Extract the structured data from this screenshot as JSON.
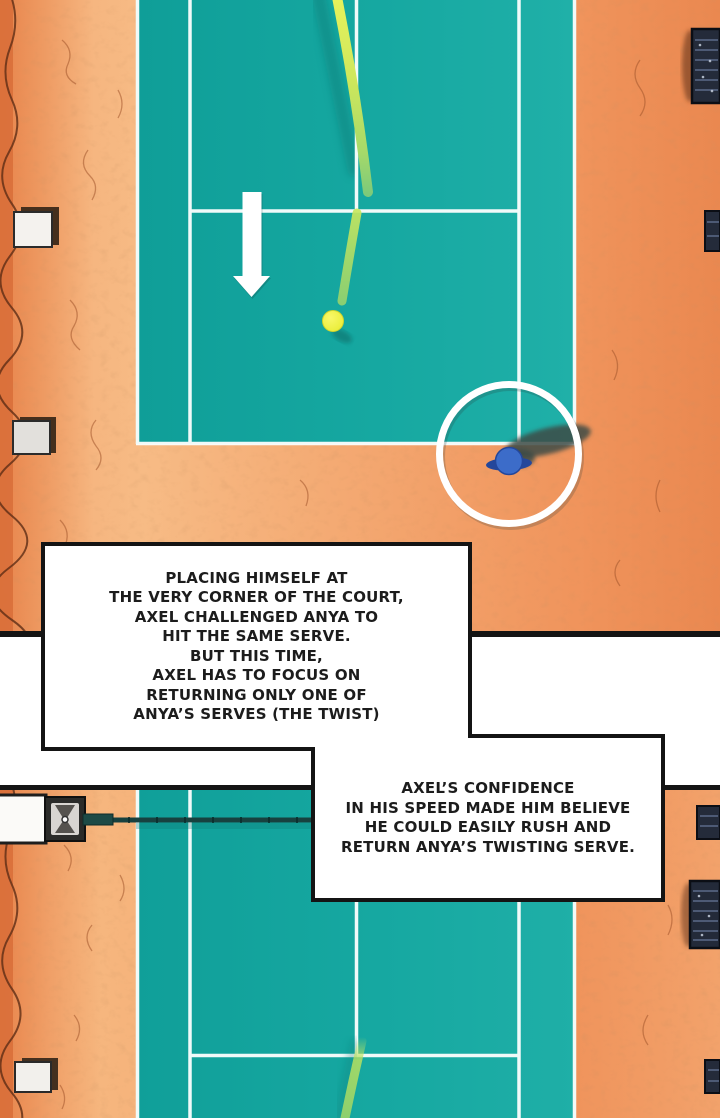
{
  "page": {
    "kind": "webtoon-comic-page",
    "width": 720,
    "height": 1118,
    "background": "#ffffff",
    "panel_count": 2
  },
  "narration": {
    "box1": {
      "text": "PLACING HIMSELF AT\nTHE VERY CORNER OF THE COURT,\nAXEL CHALLENGED ANYA TO\nHIT THE SAME SERVE.\nBUT THIS TIME,\nAXEL HAS TO FOCUS ON\nRETURNING ONLY ONE OF\nANYA’S SERVES (THE TWIST)"
    },
    "box2": {
      "text": "AXEL’S CONFIDENCE\nIN HIS SPEED MADE HIM BELIEVE\nHE COULD EASILY RUSH AND\nRETURN ANYA’S TWISTING SERVE."
    }
  },
  "scene": {
    "panel1": "top-down tennis court; serve trajectory bouncing at the service T, tennis ball, white down arrow, player standing at court corner inside a white highlight circle, benches on both sides",
    "panel2": "top-down tennis court near side of net; net with crank post at left, serve trajectory entering from service T toward bottom, benches on both sides"
  },
  "colors": {
    "court_teal": "#14a49e",
    "court_line_white": "#fafefd",
    "ground_orange": "#f0955c",
    "ground_light": "#f7bb85",
    "ground_dark": "#dd7740",
    "crack_brown": "#5e2d15",
    "trajectory_yellow": "#e9f35b",
    "trajectory_green": "#8fd073",
    "trajectory_shadow": "#0b7e79",
    "ball_yellow": "#f1f23e",
    "arrow_white": "#ffffff",
    "highlight_circle_white": "#ffffff",
    "player_blue": "#3c6cc9",
    "player_arms_blue": "#24479b",
    "cast_shadow": "#3d4b46",
    "net_dark_teal": "#17413f",
    "bench_dark": "#242b3a",
    "bench_light": "#f4f2ee",
    "panel_border_black": "#141414",
    "box_background": "#ffffff",
    "box_border_black": "#141414",
    "text_black": "#1c1c1c"
  }
}
